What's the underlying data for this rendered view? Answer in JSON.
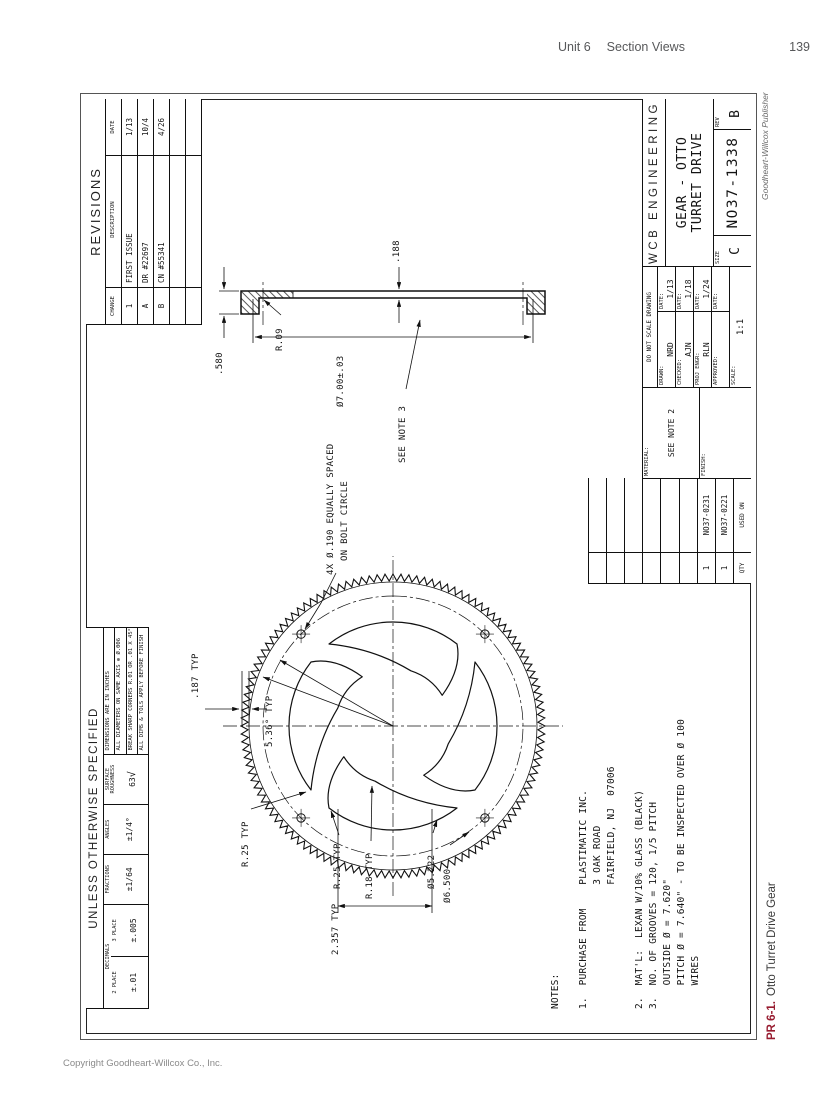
{
  "page": {
    "header": {
      "unit": "Unit 6",
      "section": "Section Views",
      "page_number": "139"
    },
    "publisher_credit": "Goodheart-Willcox Publisher",
    "caption": {
      "label": "PR 6-1.",
      "title": "Otto Turret Drive Gear"
    },
    "copyright": "Copyright Goodheart-Willcox Co., Inc."
  },
  "tolerance_block": {
    "title": "UNLESS OTHERWISE SPECIFIED",
    "decimals": {
      "header": "DECIMALS",
      "two_place_label": "2 PLACE",
      "two_place": "±.01",
      "three_place_label": "3 PLACE",
      "three_place": "±.005"
    },
    "fractions": {
      "header": "FRACTIONS",
      "value": "±1/64"
    },
    "angles": {
      "header": "ANGLES",
      "value": "±1/4°"
    },
    "surface": {
      "header": "SURFACE ROUGHNESS",
      "value": "63",
      "symbol": "√"
    },
    "notes": [
      "DIMENSIONS ARE IN INCHES",
      "ALL DIAMETERS ON SAME AXIS ⊕ Ø.006",
      "BREAK SHARP CORNERS R.01 OR .01 X 45°",
      "ALL DIMS & TOLS APPLY BEFORE FINISH"
    ]
  },
  "revisions": {
    "title": "REVISIONS",
    "columns": {
      "change": "CHANGE",
      "description": "DESCRIPTION",
      "date": "DATE"
    },
    "rows": [
      {
        "change": "1",
        "description": "FIRST ISSUE",
        "date": "1/13"
      },
      {
        "change": "A",
        "description": "DR #22697",
        "date": "10/4"
      },
      {
        "change": "B",
        "description": "CN #55341",
        "date": "4/26"
      },
      {
        "change": "",
        "description": "",
        "date": ""
      },
      {
        "change": "",
        "description": "",
        "date": ""
      }
    ]
  },
  "title_block": {
    "company": "WCB ENGINEERING",
    "drawing_title_line1": "GEAR - OTTO",
    "drawing_title_line2": "TURRET DRIVE",
    "size_label": "SIZE",
    "size": "C",
    "drawing_number": "NO37-1338",
    "rev_label": "REV",
    "rev": "B",
    "do_not_scale": "DO NOT SCALE DRAWING",
    "rows": [
      {
        "label": "DRAWN:",
        "value": "NRD",
        "date_label": "DATE:",
        "date": "1/13"
      },
      {
        "label": "CHECKED:",
        "value": "AJN",
        "date_label": "DATE:",
        "date": "1/18"
      },
      {
        "label": "PROJ ENGR:",
        "value": "RLN",
        "date_label": "DATE:",
        "date": "1/24"
      },
      {
        "label": "APPROVED:",
        "value": "",
        "date_label": "DATE:",
        "date": ""
      }
    ],
    "scale_label": "SCALE:",
    "scale": "1:1",
    "material_label": "MATERIAL:",
    "material": "SEE NOTE 2",
    "finish_label": "FINISH:",
    "finish": "",
    "application": {
      "qty_header": "QTY",
      "used_on_header": "USED ON",
      "rows": [
        {
          "qty": "",
          "part": ""
        },
        {
          "qty": "",
          "part": ""
        },
        {
          "qty": "",
          "part": ""
        },
        {
          "qty": "",
          "part": ""
        },
        {
          "qty": "",
          "part": ""
        },
        {
          "qty": "",
          "part": ""
        },
        {
          "qty": "1",
          "part": "NO37-0231"
        },
        {
          "qty": "1",
          "part": "NO37-0221"
        }
      ]
    }
  },
  "front_view": {
    "labels": {
      "groove_depth": ".187 TYP",
      "angle": "5.36° TYP",
      "r25": "R.25 TYP",
      "r18": "R.18 TYP",
      "bore": "Ø5.222",
      "bolt_circle": "Ø6.500",
      "r25b": "R.25 TYP",
      "spacing": "2.357 TYP",
      "holes_note_line1": "4X Ø.190 EQUALLY SPACED",
      "holes_note_line2": "ON BOLT CIRCLE"
    }
  },
  "section_view": {
    "labels": {
      "flange": ".188",
      "overall": ".580",
      "fillet": "R.09",
      "diameter": "Ø7.00±.03",
      "note": "SEE NOTE 3"
    }
  },
  "notes_text": "NOTES:\n\n1.  PURCHASE FROM    PLASTIMATIC INC.\n                     3 OAK ROAD\n                     FAIRFIELD, NJ  07006\n\n2.  MAT'L:  LEXAN W/10% GLASS (BLACK)\n3.  NO. OF GROOVES = 120, 1/5 PITCH\n    OUTSIDE Ø = 7.620\"\n    PITCH Ø = 7.640\" - TO BE INSPECTED OVER Ø 100\n    WIRES"
}
